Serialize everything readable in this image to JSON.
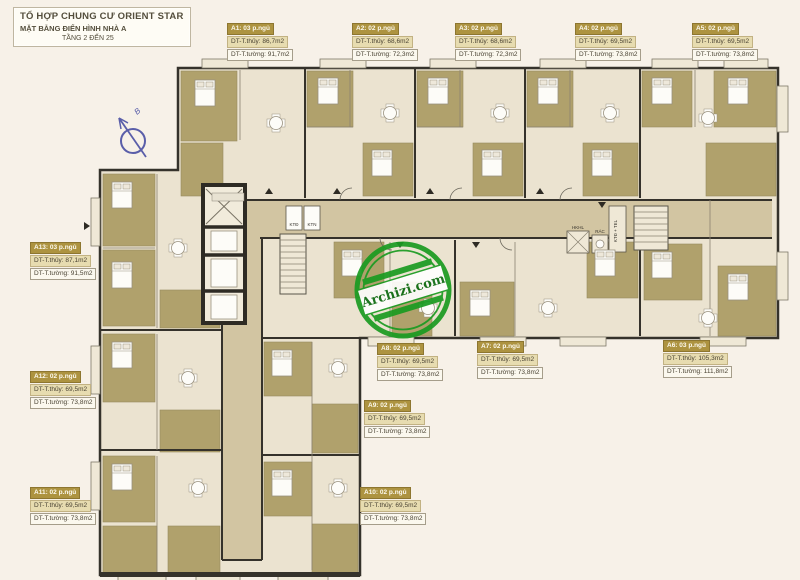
{
  "title_block": {
    "project": "TỔ HỢP CHUNG CƯ ORIENT STAR",
    "subtitle": "MẶT BẰNG ĐIỂN HÌNH NHÀ A",
    "floors": "TẦNG 2 ĐẾN 25"
  },
  "compass": {
    "north_label": "B"
  },
  "watermark": {
    "text": "Archizi.com",
    "color": "#1a9b21"
  },
  "colors": {
    "background": "#f7f1e8",
    "floor": "#ebe3d0",
    "corridor": "#d2c5a2",
    "room_block": "#b0a16c",
    "wall": "#35322b",
    "label_header_bg": "#ad9340",
    "label_area_bg": "#e7dcb0",
    "compass_blue": "#5a5ea9",
    "watermark_green": "#1a9b21"
  },
  "units": [
    {
      "id": "A1",
      "header": "A1: 03 p.ngủ",
      "net_area": "DT-T.thủy: 86,7m2",
      "gross_area": "DT-T.tường: 91,7m2"
    },
    {
      "id": "A2",
      "header": "A2: 02 p.ngủ",
      "net_area": "DT-T.thủy: 68,6m2",
      "gross_area": "DT-T.tường: 72,3m2"
    },
    {
      "id": "A3",
      "header": "A3: 02 p.ngủ",
      "net_area": "DT-T.thủy: 68,6m2",
      "gross_area": "DT-T.tường: 72,3m2"
    },
    {
      "id": "A4",
      "header": "A4: 02 p.ngủ",
      "net_area": "DT-T.thủy: 69,5m2",
      "gross_area": "DT-T.tường: 73,8m2"
    },
    {
      "id": "A5",
      "header": "A5: 02 p.ngủ",
      "net_area": "DT-T.thủy: 69,5m2",
      "gross_area": "DT-T.tường: 73,8m2"
    },
    {
      "id": "A6",
      "header": "A6: 03 p.ngủ",
      "net_area": "DT-T.thủy: 105,3m2",
      "gross_area": "DT-T.tường: 111,8m2"
    },
    {
      "id": "A7",
      "header": "A7: 02 p.ngủ",
      "net_area": "DT-T.thủy: 69,5m2",
      "gross_area": "DT-T.tường: 73,8m2"
    },
    {
      "id": "A8",
      "header": "A8: 02 p.ngủ",
      "net_area": "DT-T.thủy: 69,5m2",
      "gross_area": "DT-T.tường: 73,8m2"
    },
    {
      "id": "A9",
      "header": "A9: 02 p.ngủ",
      "net_area": "DT-T.thủy: 69,5m2",
      "gross_area": "DT-T.tường: 73,8m2"
    },
    {
      "id": "A10",
      "header": "A10: 02 p.ngủ",
      "net_area": "DT-T.thủy: 69,5m2",
      "gross_area": "DT-T.tường: 73,8m2"
    },
    {
      "id": "A11",
      "header": "A11: 02 p.ngủ",
      "net_area": "DT-T.thủy: 69,5m2",
      "gross_area": "DT-T.tường: 73,8m2"
    },
    {
      "id": "A12",
      "header": "A12: 02 p.ngủ",
      "net_area": "DT-T.thủy: 69,5m2",
      "gross_area": "DT-T.tường: 73,8m2"
    },
    {
      "id": "A13",
      "header": "A13: 03 p.ngủ",
      "net_area": "DT-T.thủy: 87,1m2",
      "gross_area": "DT-T.tường: 91,5m2"
    }
  ],
  "service_rooms": {
    "ktd": "KTĐ",
    "ktn": "KTN",
    "hkhl": "HKHL",
    "rac": "RÁC",
    "ktd_tel": "KTĐ + TEL"
  }
}
